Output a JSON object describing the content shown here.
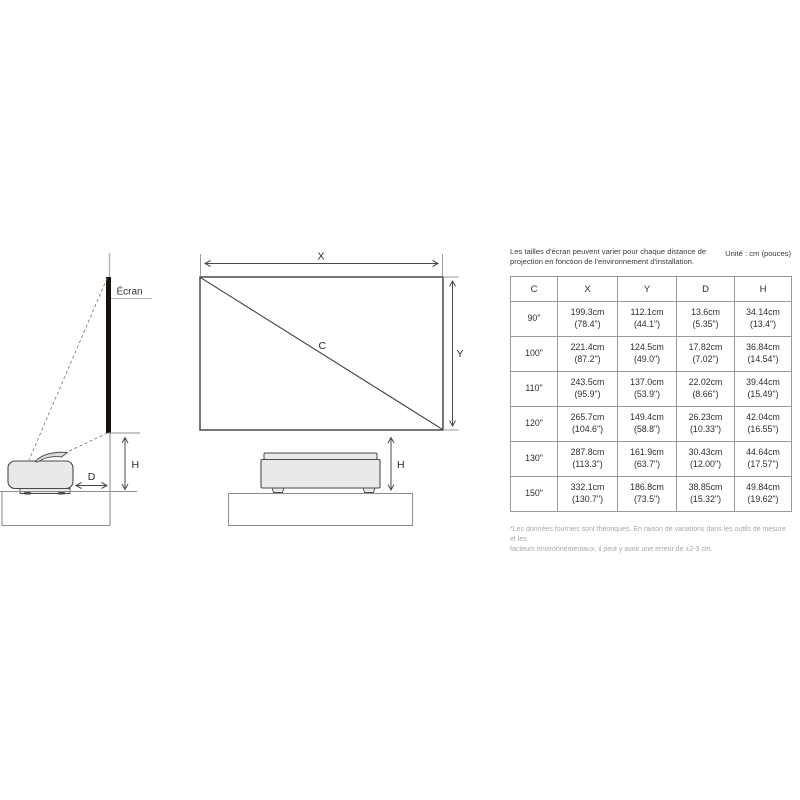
{
  "info": {
    "intro": "Les tailles d'écran peuvent varier pour chaque distance de\nprojection en fonction de l'environnement d'installation.",
    "unit": "Unité : cm (pouces)",
    "footnote": "*Les données fournies sont théoriques. En raison de variations dans les outils de mesure et les\nfacteurs environnementaux, il peut y avoir une erreur de ±2-3 cm."
  },
  "diagram": {
    "screen_label": "Écran",
    "width_label": "X",
    "height_label": "Y",
    "diagonal_label": "C",
    "distance_label": "D",
    "side_height_label": "H",
    "front_height_label": "H"
  },
  "table": {
    "headers": [
      "C",
      "X",
      "Y",
      "D",
      "H"
    ],
    "rows": [
      [
        "90\"",
        "199.3cm",
        "(78.4\")",
        "112.1cm",
        "(44.1\")",
        "13.6cm",
        "(5.35\")",
        "34.14cm",
        "(13.4\")"
      ],
      [
        "100\"",
        "221.4cm",
        "(87.2\")",
        "124.5cm",
        "(49.0\")",
        "17.82cm",
        "(7.02\")",
        "36.84cm",
        "(14.54\")"
      ],
      [
        "110\"",
        "243.5cm",
        "(95.9\")",
        "137.0cm",
        "(53.9\")",
        "22.02cm",
        "(8.66\")",
        "39.44cm",
        "(15.49\")"
      ],
      [
        "120\"",
        "265.7cm",
        "(104.6\")",
        "149.4cm",
        "(58.8\")",
        "26.23cm",
        "(10.33\")",
        "42.04cm",
        "(16.55\")"
      ],
      [
        "130\"",
        "287.8cm",
        "(113.3\")",
        "161.9cm",
        "(63.7\")",
        "30.43cm",
        "(12.00\")",
        "44.64cm",
        "(17.57\")"
      ],
      [
        "150\"",
        "332.1cm",
        "(130.7\")",
        "186.8cm",
        "(73.5\")",
        "38.85cm",
        "(15.32\")",
        "49.84cm",
        "(19.62\")"
      ]
    ]
  },
  "colors": {
    "line": "#4a4a4a",
    "light_line": "#9c9c9c",
    "screen_bar": "#17120e",
    "projector_fill": "#e9e9e9",
    "table_border": "#9a9a9a",
    "text": "#2e2e2e",
    "muted_text": "#a8a8a8"
  }
}
